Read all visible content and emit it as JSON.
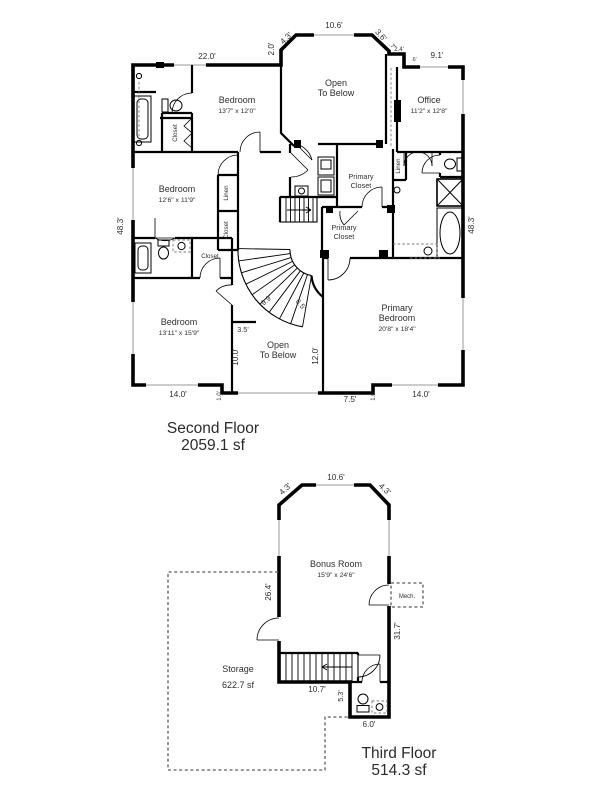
{
  "colors": {
    "wall": "#000000",
    "text": "#2f2f2f",
    "dashed": "#5c5c5c",
    "window": "#9a9a9a",
    "background": "#ffffff"
  },
  "sf": {
    "title": "Second Floor",
    "area": "2059.1 sf",
    "bedroom1_name": "Bedroom",
    "bedroom1_dims": "13'7\" x 12'0\"",
    "open1_l1": "Open",
    "open1_l2": "To Below",
    "office_name": "Office",
    "office_dims": "11'2\" x 12'8\"",
    "bedroom2_name": "Bedroom",
    "bedroom2_dims": "12'6\" x 11'9\"",
    "pc1_l1": "Primary",
    "pc1_l2": "Closet",
    "pc2_l1": "Primary",
    "pc2_l2": "Closet",
    "bedroom3_name": "Bedroom",
    "bedroom3_dims": "13'11\" x 15'9\"",
    "open2_l1": "Open",
    "open2_l2": "To Below",
    "pb_l1": "Primary",
    "pb_l2": "Bedroom",
    "pb_dims": "20'8\" x 18'4\"",
    "closet_a": "Closet",
    "closet_b": "Closet",
    "closet_c": "Closet",
    "linen_a": "Linen",
    "linen_b": "Linen",
    "d_220": "22.0'",
    "d_20": "2.0'",
    "d_43": "4.3'",
    "d_106": "10.6'",
    "d_36": "3.6'",
    "d_07": ".7'",
    "d_24": "2.4'",
    "d_06": ".6'",
    "d_91": "9.1'",
    "d_483L": "48.3'",
    "d_483R": "48.3'",
    "d_140L": "14.0'",
    "d_10L": "1.0'",
    "d_75": "7.5'",
    "d_10R": "1.0'",
    "d_140R": "14.0'",
    "d_99": "9.9'",
    "d_65": "6.5'",
    "d_35": "3.5'",
    "d_100": "10.0'",
    "d_120": "12.0'"
  },
  "tf": {
    "title": "Third Floor",
    "area": "514.3 sf",
    "bonus_name": "Bonus Room",
    "bonus_dims": "15'9\" x 24'6\"",
    "mech": "Mech.",
    "storage_name": "Storage",
    "storage_area": "622.7 sf",
    "d_43L": "4.3'",
    "d_106": "10.6'",
    "d_43R": "4.3'",
    "d_264": "26.4'",
    "d_317": "31.7'",
    "d_107": "10.7'",
    "d_53": "5.3'",
    "d_60": "6.0'"
  }
}
